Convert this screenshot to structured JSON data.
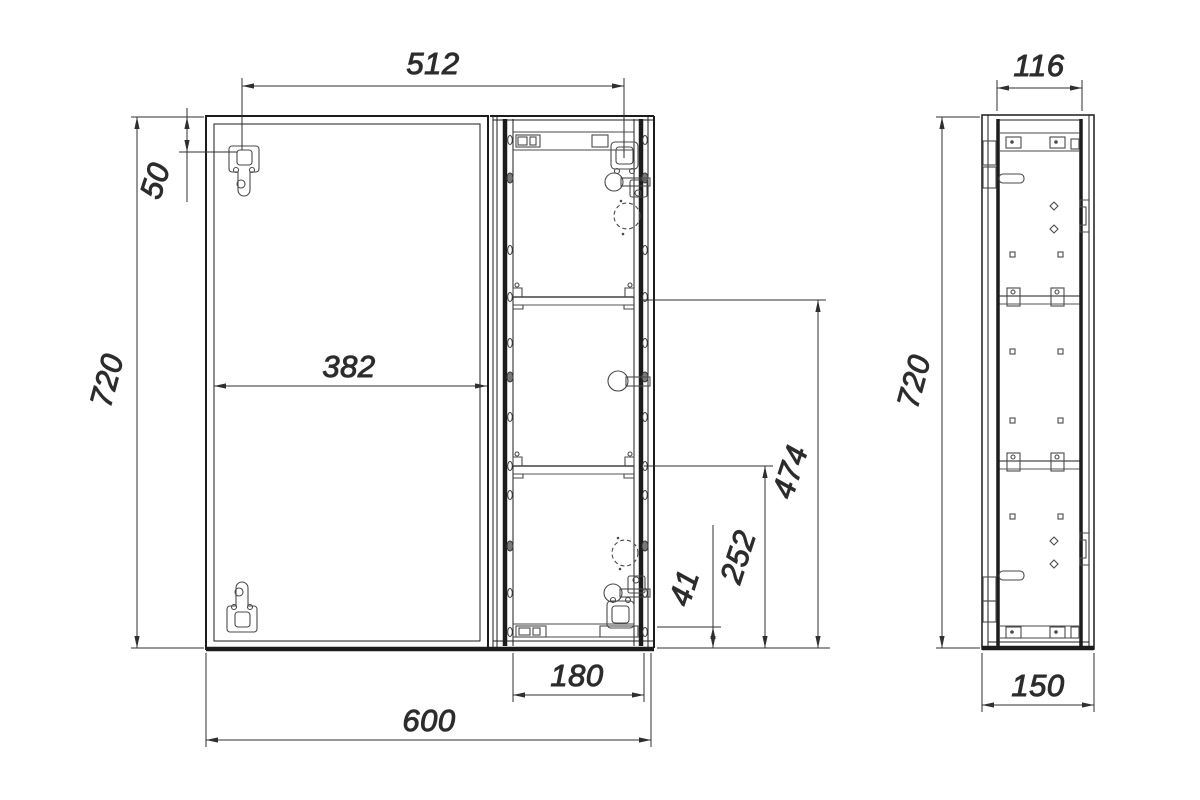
{
  "drawing": {
    "canvas": {
      "background": "#ffffff",
      "line_color": "#1c1c1c",
      "dimension_color": "#2f2f2f"
    },
    "front_view": {
      "dim_hinge_span": "512",
      "dim_hinge_offset_top": "50",
      "dim_overall_height": "720",
      "dim_door_width": "382",
      "dim_overall_width": "600",
      "dim_shelf_section_width": "180",
      "dim_bottom_rail_offset": "41",
      "dim_lower_shelf_height": "252",
      "dim_upper_shelf_height": "474"
    },
    "side_view": {
      "dim_inner_depth": "116",
      "dim_overall_height": "720",
      "dim_overall_depth": "150"
    }
  }
}
